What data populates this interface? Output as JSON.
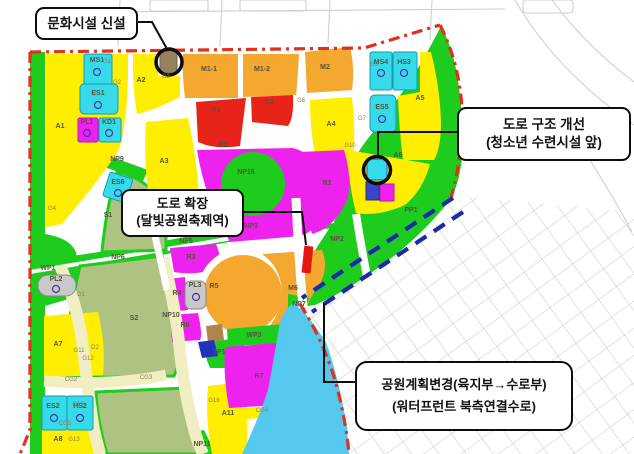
{
  "callouts": {
    "culture": {
      "line1": "문화시설 신설"
    },
    "road_structure": {
      "line1": "도로 구조 개선",
      "line2": "(청소년 수련시설 앞)"
    },
    "road_expansion": {
      "line1": "도로 확장",
      "line2": "(달빛공원축제역)"
    },
    "park_change": {
      "line1": "공원계획변경(육지부→수로부)",
      "line2": "(워터프런트 북측연결수로)"
    }
  },
  "map_labels": {
    "zones": [
      {
        "t": "A1",
        "x": 60,
        "y": 128
      },
      {
        "t": "A2",
        "x": 141,
        "y": 82
      },
      {
        "t": "A3",
        "x": 164,
        "y": 163
      },
      {
        "t": "A4",
        "x": 331,
        "y": 126
      },
      {
        "t": "A5",
        "x": 420,
        "y": 100
      },
      {
        "t": "A6",
        "x": 398,
        "y": 157
      },
      {
        "t": "A7",
        "x": 58,
        "y": 346
      },
      {
        "t": "A8",
        "x": 58,
        "y": 441
      },
      {
        "t": "A11",
        "x": 228,
        "y": 415
      },
      {
        "t": "M1-1",
        "x": 209,
        "y": 71
      },
      {
        "t": "M1-2",
        "x": 262,
        "y": 71
      },
      {
        "t": "M2",
        "x": 325,
        "y": 69
      },
      {
        "t": "M6",
        "x": 293,
        "y": 290
      },
      {
        "t": "B1",
        "x": 216,
        "y": 112
      },
      {
        "t": "B2",
        "x": 269,
        "y": 104
      },
      {
        "t": "R1",
        "x": 327,
        "y": 185
      },
      {
        "t": "R2",
        "x": 223,
        "y": 147
      },
      {
        "t": "R3",
        "x": 191,
        "y": 259
      },
      {
        "t": "R4",
        "x": 177,
        "y": 295
      },
      {
        "t": "R5",
        "x": 214,
        "y": 288
      },
      {
        "t": "R6",
        "x": 185,
        "y": 327
      },
      {
        "t": "R7",
        "x": 259,
        "y": 378
      },
      {
        "t": "S1",
        "x": 108,
        "y": 217
      },
      {
        "t": "S2",
        "x": 134,
        "y": 320
      },
      {
        "t": "NP2",
        "x": 337,
        "y": 241
      },
      {
        "t": "NP3",
        "x": 251,
        "y": 228
      },
      {
        "t": "NP5",
        "x": 186,
        "y": 243
      },
      {
        "t": "NP6",
        "x": 118,
        "y": 259
      },
      {
        "t": "NP7",
        "x": 299,
        "y": 306
      },
      {
        "t": "NP9",
        "x": 117,
        "y": 161
      },
      {
        "t": "NP10",
        "x": 171,
        "y": 317
      },
      {
        "t": "NP11",
        "x": 202,
        "y": 446
      },
      {
        "t": "NP16",
        "x": 246,
        "y": 174
      },
      {
        "t": "PP1",
        "x": 411,
        "y": 212
      },
      {
        "t": "WP1",
        "x": 48,
        "y": 270
      },
      {
        "t": "WP3",
        "x": 254,
        "y": 337
      },
      {
        "t": "SP1",
        "x": 219,
        "y": 354
      },
      {
        "t": "MS1",
        "x": 97,
        "y": 62
      },
      {
        "t": "ES1",
        "x": 98,
        "y": 95
      },
      {
        "t": "PL1",
        "x": 87,
        "y": 124
      },
      {
        "t": "KD1",
        "x": 109,
        "y": 124
      },
      {
        "t": "MS4",
        "x": 381,
        "y": 64
      },
      {
        "t": "HS3",
        "x": 404,
        "y": 64
      },
      {
        "t": "ES5",
        "x": 382,
        "y": 109
      },
      {
        "t": "ES6",
        "x": 118,
        "y": 184
      },
      {
        "t": "PL2",
        "x": 56,
        "y": 281
      },
      {
        "t": "PL3",
        "x": 195,
        "y": 287
      },
      {
        "t": "ES2",
        "x": 53,
        "y": 408
      },
      {
        "t": "HS2",
        "x": 80,
        "y": 408
      }
    ],
    "roads": [
      {
        "t": "G1",
        "x": 107,
        "y": 63
      },
      {
        "t": "G2",
        "x": 117,
        "y": 84
      },
      {
        "t": "G3",
        "x": 166,
        "y": 78
      },
      {
        "t": "G4",
        "x": 52,
        "y": 210
      },
      {
        "t": "G6",
        "x": 301,
        "y": 102
      },
      {
        "t": "G7",
        "x": 362,
        "y": 120
      },
      {
        "t": "G9",
        "x": 374,
        "y": 66
      },
      {
        "t": "G10",
        "x": 350,
        "y": 147
      },
      {
        "t": "G11",
        "x": 79,
        "y": 352
      },
      {
        "t": "G12",
        "x": 88,
        "y": 360
      },
      {
        "t": "G13",
        "x": 78,
        "y": 406
      },
      {
        "t": "G13",
        "x": 74,
        "y": 441
      },
      {
        "t": "G16",
        "x": 214,
        "y": 402
      },
      {
        "t": "CG2",
        "x": 71,
        "y": 381
      },
      {
        "t": "CG3",
        "x": 146,
        "y": 379
      },
      {
        "t": "CG4",
        "x": 262,
        "y": 412
      },
      {
        "t": "CG5",
        "x": 65,
        "y": 425
      },
      {
        "t": "D1",
        "x": 81,
        "y": 296
      },
      {
        "t": "D2",
        "x": 95,
        "y": 349
      }
    ]
  },
  "palette": {
    "boundary_red": "#e0301e",
    "waterway_dash_blue": "#1a2aaa",
    "water_blue": "#55c8f0",
    "residential_yellow": "#ffee00",
    "commercial_red": "#e8231a",
    "mixed_use_orange": "#f5a830",
    "high_density_magenta": "#ee22ee",
    "park_green": "#1ecc1e",
    "school_cyan": "#35dbe8",
    "open_space_olive": "#aec382",
    "greenway_cream": "#f0eec2"
  }
}
